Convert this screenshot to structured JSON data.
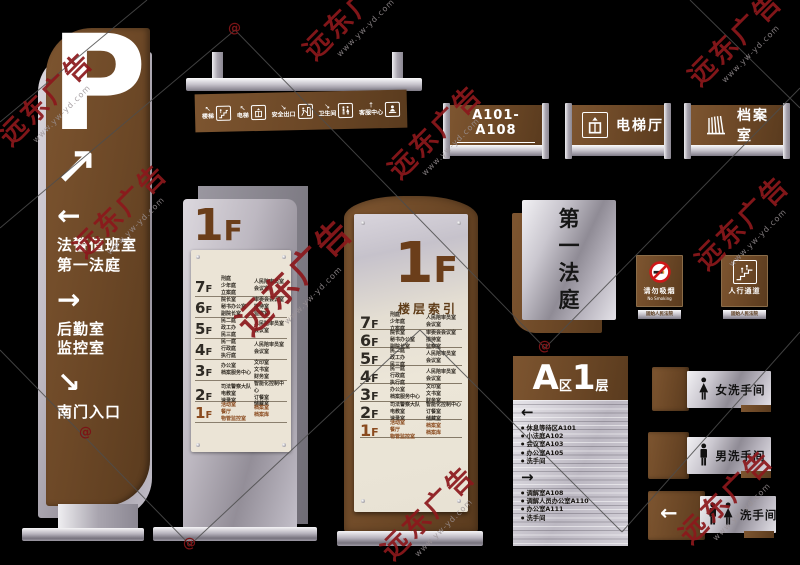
{
  "watermark": {
    "text": "远东广告",
    "url": "www.yw-yd.com",
    "at": "@"
  },
  "p_pylon": {
    "symbol": "P",
    "arrow_main": "↗",
    "groups": [
      {
        "arrow": "←",
        "lines": [
          "法警值班室",
          "第一法庭"
        ]
      },
      {
        "arrow": "→",
        "lines": [
          "后勤室",
          "监控室"
        ]
      },
      {
        "arrow": "↘",
        "lines": [
          "南门入口"
        ]
      }
    ]
  },
  "hanging_sign": {
    "items": [
      {
        "arrow": "↖",
        "label": "楼梯",
        "icon": "stairs-icon"
      },
      {
        "arrow": "↖",
        "label": "电梯",
        "icon": "elevator-icon"
      },
      {
        "arrow": "↘",
        "label": "安全出口",
        "icon": "exit-icon"
      },
      {
        "arrow": "↘",
        "label": "卫生间",
        "icon": "toilet-icon"
      },
      {
        "arrow": "↑",
        "label": "客服中心",
        "icon": "service-icon"
      }
    ]
  },
  "floor_directory": {
    "floor_num": "1",
    "floor_suf": "F",
    "subtitle": "楼层索引",
    "rows": [
      {
        "num": "7",
        "suf": "F",
        "left": [
          "刑庭",
          "少年庭",
          "立案庭"
        ],
        "right": [
          "人民陪审员室",
          "会议室"
        ],
        "highlight": false
      },
      {
        "num": "6",
        "suf": "F",
        "left": [
          "院长室",
          "秘书办公室",
          "副院长室"
        ],
        "right": [
          "审委会会议室",
          "接待室",
          "监察室"
        ],
        "highlight": false
      },
      {
        "num": "5",
        "suf": "F",
        "left": [
          "民二庭",
          "政工办",
          "民三庭"
        ],
        "right": [
          "人民陪审员室",
          "会议室"
        ],
        "highlight": false
      },
      {
        "num": "4",
        "suf": "F",
        "left": [
          "民一庭",
          "行政庭",
          "执行庭"
        ],
        "right": [
          "人民陪审员室",
          "会议室"
        ],
        "highlight": false
      },
      {
        "num": "3",
        "suf": "F",
        "left": [
          "办公室",
          "档案服务中心"
        ],
        "right": [
          "文印室",
          "文书室",
          "财务室"
        ],
        "highlight": false
      },
      {
        "num": "2",
        "suf": "F",
        "left": [
          "司法警察大队",
          "电教室",
          "速录室"
        ],
        "right": [
          "智能化控制中心",
          "订餐室",
          "储藏室"
        ],
        "highlight": false
      },
      {
        "num": "1",
        "suf": "F",
        "left": [
          "活动室",
          "餐厅",
          "物管监控室"
        ],
        "right": [
          "档案室",
          "档案库"
        ],
        "highlight": true
      }
    ]
  },
  "door_signs": [
    {
      "label": "A101-A108"
    },
    {
      "label": "电梯厅",
      "icon": "elevator-icon"
    },
    {
      "label": "档案室",
      "icon": "files-icon"
    }
  ],
  "court_sign": {
    "chars": [
      "第",
      "一",
      "法",
      "庭"
    ]
  },
  "small_signs": [
    {
      "label": "请勿吸烟",
      "sublabel": "No Smoking",
      "strip": "固始人民法院",
      "icon": "no-smoking-icon"
    },
    {
      "label": "人行通道",
      "strip": "固始人民法院",
      "icon": "stairs-people-icon"
    }
  ],
  "zone_directory": {
    "zone": "A",
    "zone_suffix": "区",
    "floor": "1",
    "floor_suffix": "层",
    "bullet": "●",
    "left_arrow": "←",
    "right_arrow": "→",
    "left_items": [
      "休息等待区A101",
      "小法庭A102",
      "会议室A103",
      "办公室A105",
      "洗手间"
    ],
    "right_items": [
      "调解室A108",
      "调解人员办公室A110",
      "办公室A111",
      "洗手间"
    ]
  },
  "restroom_signs": [
    {
      "label": "女洗手间",
      "icon": "female-icon"
    },
    {
      "label": "男洗手间",
      "icon": "male-icon"
    },
    {
      "label": "洗手间",
      "icon": "mf-icon",
      "arrow": "←"
    }
  ]
}
